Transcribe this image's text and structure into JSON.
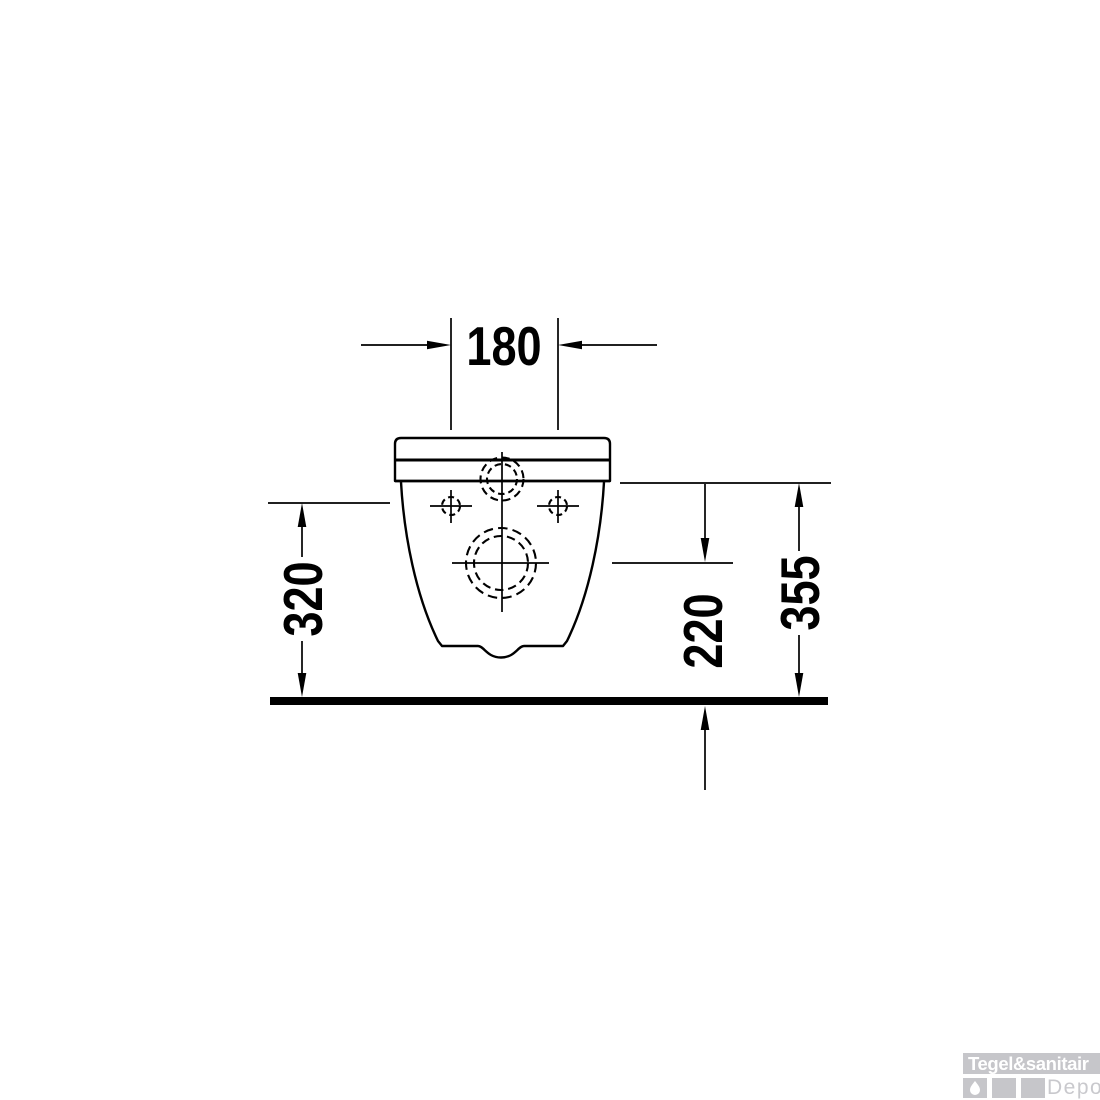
{
  "drawing": {
    "type": "technical-dimension-diagram",
    "subject": "wall-hung toilet, rear view",
    "line_color": "#000000",
    "dimensions": {
      "fixing_hole_spacing": "180",
      "fixing_hole_height": "320",
      "outlet_height": "220",
      "total_height": "355"
    }
  },
  "watermark": {
    "title": "Tegel&sanitair",
    "subtitle": "Depot",
    "band_color": "#c6c6ca",
    "square_color": "#c6c6ca",
    "title_color": "#ffffff",
    "subtitle_color": "#c9c9cd",
    "icon": "water-drop-icon"
  }
}
